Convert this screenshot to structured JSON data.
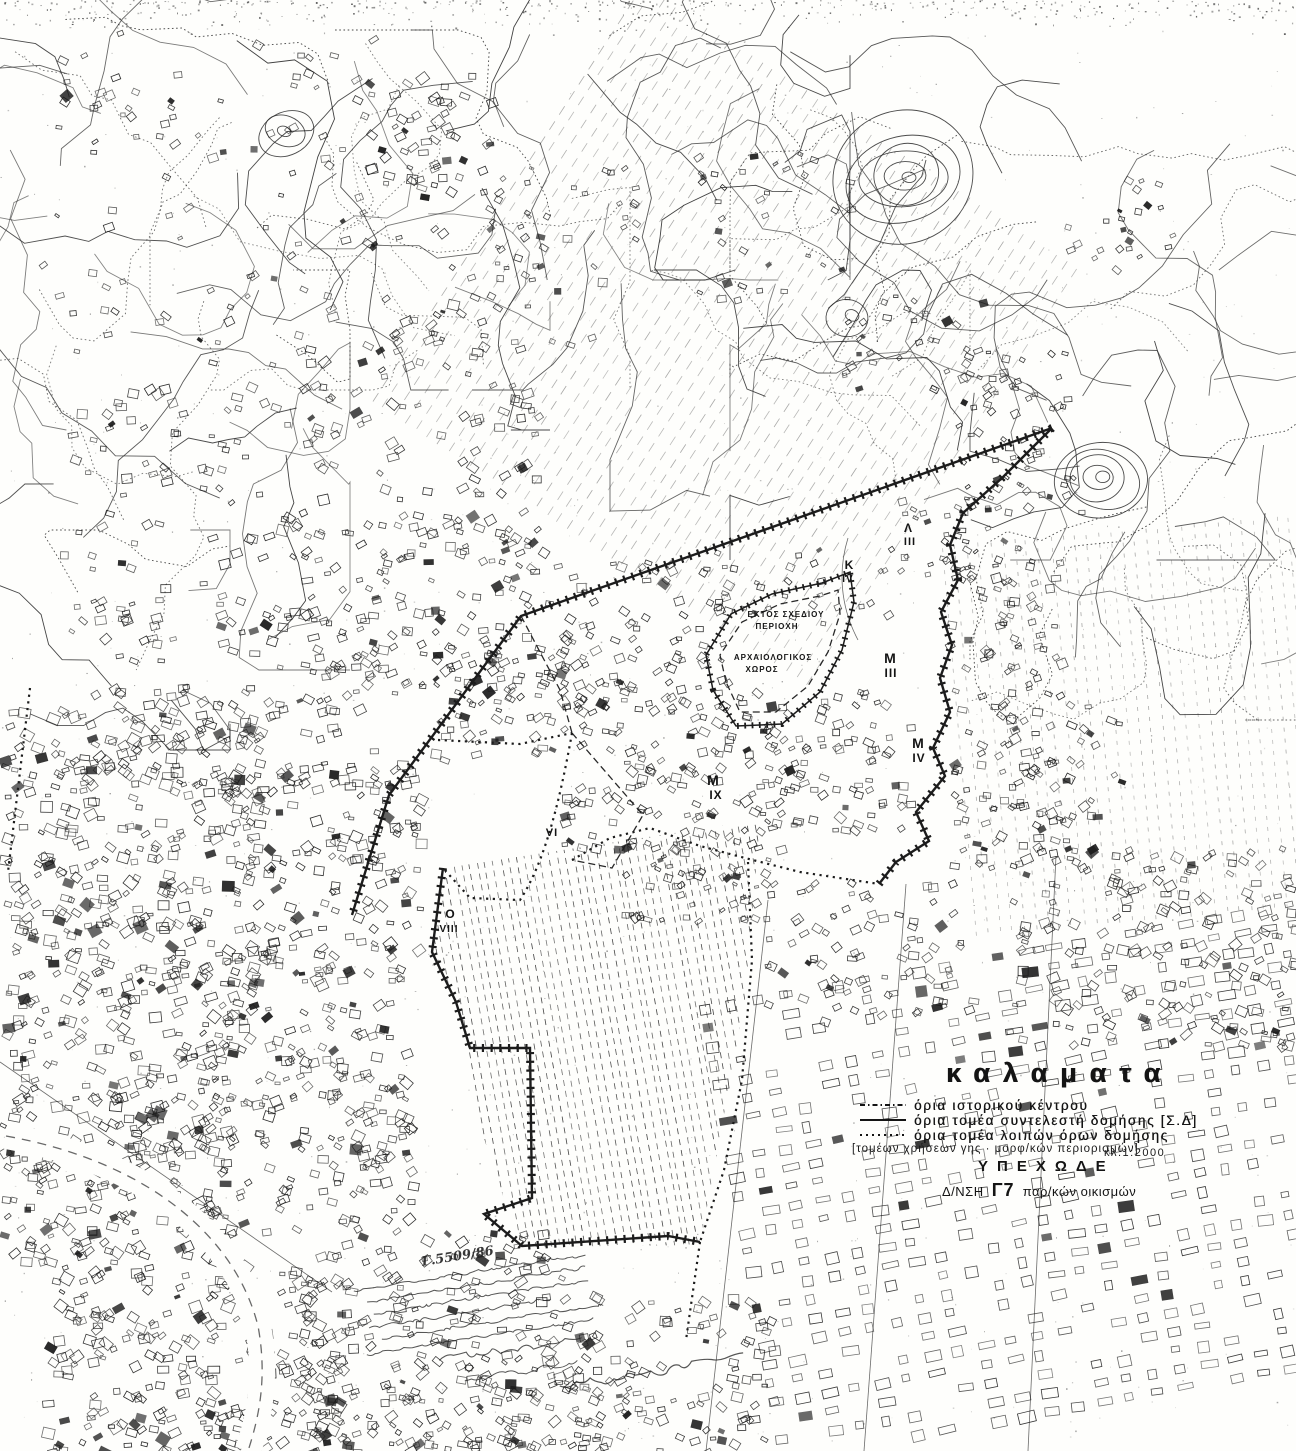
{
  "map": {
    "ink": "#1c1c1c",
    "paper": "#fefefc",
    "region_labels": [
      {
        "text": "Λ",
        "x": 908,
        "y": 532,
        "size": 12,
        "ls": 0
      },
      {
        "text": "III",
        "x": 910,
        "y": 545,
        "size": 11,
        "ls": 1
      },
      {
        "text": "K",
        "x": 849,
        "y": 569,
        "size": 12,
        "ls": 0
      },
      {
        "text": "IV",
        "x": 848,
        "y": 582,
        "size": 10,
        "ls": 1
      },
      {
        "text": "M",
        "x": 890,
        "y": 663,
        "size": 14,
        "ls": 0
      },
      {
        "text": "III",
        "x": 891,
        "y": 677,
        "size": 12,
        "ls": 1
      },
      {
        "text": "M",
        "x": 918,
        "y": 748,
        "size": 14,
        "ls": 0
      },
      {
        "text": "IV",
        "x": 919,
        "y": 762,
        "size": 12,
        "ls": 1
      },
      {
        "text": "M",
        "x": 713,
        "y": 785,
        "size": 14,
        "ls": 0
      },
      {
        "text": "IX",
        "x": 716,
        "y": 799,
        "size": 12,
        "ls": 1
      },
      {
        "text": "VI",
        "x": 552,
        "y": 836,
        "size": 11,
        "ls": 1
      },
      {
        "text": "O",
        "x": 450,
        "y": 918,
        "size": 12,
        "ls": 0
      },
      {
        "text": "VIII",
        "x": 449,
        "y": 932,
        "size": 10,
        "ls": 1
      },
      {
        "text": "ΕΚΤΟΣ ΣΧΕΔΙΟΥ",
        "x": 786,
        "y": 617,
        "size": 8,
        "ls": 1
      },
      {
        "text": "ΠΕΡΙΟΧΗ",
        "x": 777,
        "y": 629,
        "size": 8,
        "ls": 1
      },
      {
        "text": "ΑΡΧΑΙΟΛΟΓΙΚΟΣ",
        "x": 773,
        "y": 660,
        "size": 8,
        "ls": 1
      },
      {
        "text": "ΧΩΡΟΣ",
        "x": 762,
        "y": 672,
        "size": 8,
        "ls": 1
      }
    ],
    "features": [
      {
        "name": "sd-boundary-northwest",
        "style": "heavy",
        "d": "M1052,428 L521,616 L389,795 L352,915"
      },
      {
        "name": "sd-boundary-east",
        "style": "heavy",
        "d": "M1052,428 L1002,478 L963,513 L950,545 L958,580 L941,612 L952,645 L940,678 L950,712 L933,748 L945,776 L916,812 L929,841 L896,862 L879,884"
      },
      {
        "name": "sd-boundary-southwest",
        "style": "heavy",
        "d": "M443,868 L432,952 L456,1002 L470,1048 L530,1048 L532,1198 L484,1214 L522,1246 L668,1236 L700,1242"
      },
      {
        "name": "boundary-south-extension",
        "style": "dotted",
        "d": "M700,1242 L686,1340"
      },
      {
        "name": "lobe-north-boundary",
        "style": "dotted",
        "d": "M572,860 L610,838 L650,828 L700,846 L745,858 L800,872 L879,884"
      },
      {
        "name": "lobe-east-boundary",
        "style": "dotted",
        "d": "M748,862 L752,960 L742,1080 L724,1170 L700,1242"
      },
      {
        "name": "vi-area-north",
        "style": "dotted",
        "d": "M438,740 L520,744 L572,733"
      },
      {
        "name": "vi-area-west",
        "style": "dotted",
        "d": "M572,733 C560,800 545,862 520,900 L470,898 L443,868"
      },
      {
        "name": "vi-area-east",
        "style": "dashed",
        "d": "M572,733 L643,815 L612,868 L572,860"
      },
      {
        "name": "sd-link-north",
        "style": "dashed",
        "d": "M521,616 L560,690 L572,733"
      },
      {
        "name": "archaeological-site-outline",
        "style": "hatched",
        "d": "M713,690 L706,655 L731,614 L772,594 L822,583 L850,572 L854,602 L842,650 L820,692 L782,724 L736,726 Z"
      },
      {
        "name": "archaeological-site-inner",
        "style": "dashed",
        "d": "M726,682 L720,655 L742,622 L780,604 L820,596 L838,590 L840,614 L828,652 L808,686 L776,712 L740,712 Z"
      },
      {
        "name": "historic-center-road",
        "style": "thinline",
        "d": "M848,538 C838,570 840,606 858,640"
      },
      {
        "name": "west-tick-line",
        "style": "dotted",
        "d": "M30,688 L8,872"
      },
      {
        "name": "ring-road",
        "style": "whiteroad",
        "d": "M6,1136 C150,1162 236,1238 258,1326 C268,1380 258,1420 248,1451"
      },
      {
        "name": "street-a",
        "style": "thinline",
        "d": "M768,900 L706,1451"
      },
      {
        "name": "street-b",
        "style": "thinline",
        "d": "M906,884 L864,1451"
      },
      {
        "name": "street-c",
        "style": "thinline",
        "d": "M1056,856 L1028,1451"
      },
      {
        "name": "street-d",
        "style": "thinline",
        "d": "M0,1062 L332,1292"
      }
    ]
  },
  "legend": {
    "title": "καλαματα",
    "rows": [
      {
        "style": "dashdot",
        "label": "όρια ιστορικού κέντρου"
      },
      {
        "style": "solid",
        "label": "όρια τομέα συντελεστή δομήσης [Σ.Δ]"
      },
      {
        "style": "dotted",
        "label": "όρια τομέα λοιπών όρων δομήσης"
      }
    ],
    "note": "[τομέων χρήσεων γης · μορφ/κών περιορισμών]",
    "scale": "κλ.1:2000",
    "agency": "ΥΠΕΧΩΔΕ",
    "dept_prefix": "Δ/ΝΣΗ",
    "dept_code": "Γ7",
    "dept_rest": "παρ/κών οικισμών"
  },
  "annotations": {
    "ref_number": "Γ.5509/86"
  }
}
